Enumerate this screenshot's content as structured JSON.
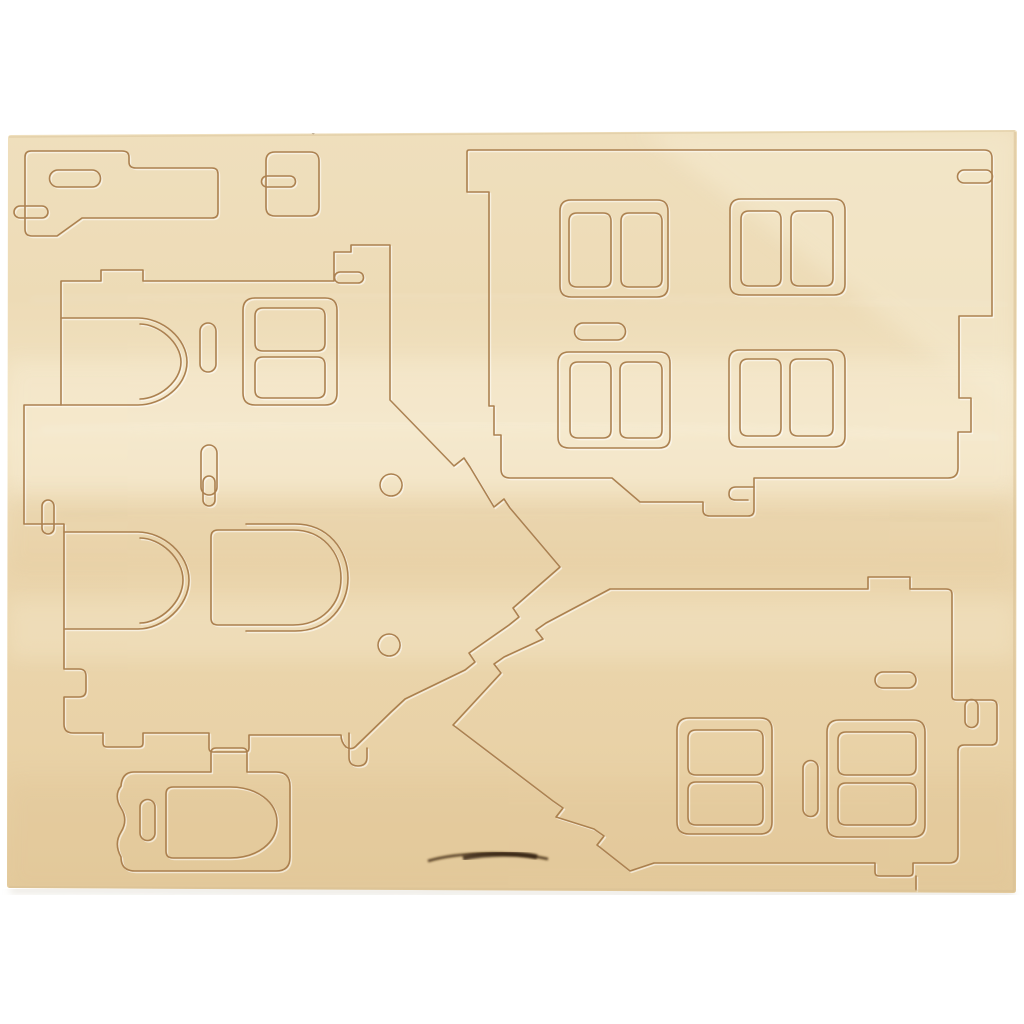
{
  "meta": {
    "description": "Photograph of a light birch plywood sheet with laser die-cut pieces for a 3D wooden house construction kit. No text is visible in the image.",
    "object": "wooden 3D-puzzle punch-out sheet",
    "piece_count_visible": 7
  },
  "colors": {
    "background": "#ffffff",
    "wood_top": "#efdfbd",
    "wood_upper": "#eddbb6",
    "wood_light": "#f3e5c6",
    "wood_mid": "#ebd6ae",
    "wood_lower": "#e9d2a7",
    "wood_bottom": "#e4cb9d",
    "band_light": "#f8eed6",
    "band_warm": "#dfc08c",
    "edge_line": "#d8c094",
    "cut_line": "#a87c4a",
    "emboss": "#ffffff",
    "burn": "#3c2710",
    "shadow": "#d8d2c4"
  },
  "pieces": [
    {
      "name": "chimney-support",
      "location": "top-left"
    },
    {
      "name": "small-connector-block",
      "location": "top-center-left"
    },
    {
      "name": "front-wall-four-windows",
      "location": "top-right"
    },
    {
      "name": "side-wall-arched-doorways",
      "location": "center-left"
    },
    {
      "name": "arched-door-panel",
      "location": "center"
    },
    {
      "name": "door-frame-panel",
      "location": "bottom-left"
    },
    {
      "name": "gable-wall-two-windows",
      "location": "bottom-right"
    }
  ],
  "sheet": {
    "outline": "M11,135 L1014,130 Q1017,130 1017,133 L1016,890 Q1016,893 1013,893 L10,888 Q7,888 7,885 L8,138 Q8,135 11,135 Z"
  },
  "grain": {
    "diag_highlight": "M1017,130 L640,130 L1017,420 Z",
    "mid_band": "M7,360 H1017 V500 H7 Z",
    "warm_band": "M7,492 H1017 V575 H7 Z",
    "low_light_band": "M7,600 H1017 V660 H7 Z",
    "bottom_band": "M7,780 H1017 V893 H7 Z",
    "streak1": "M40,430 C300,420 700,425 1000,438",
    "streak2": "M60,515 C350,505 650,512 990,520",
    "streak3": "M30,300 C300,292 600,296 1010,305",
    "burn_main": "M428,861 C458,852 512,851 548,859",
    "burn_core": "M463,858 C488,853 520,853 537,857",
    "speck": "M311,132 a2.2,2.2 0 1 0 4.4,0 a2.2,2.2 0 1 0 -4.4,0 Z"
  },
  "cuts": {
    "chimney_outline": "M31,151 H122 Q129,151 129,157 V162 Q129,168 136,168 H212 Q218,168 218,174 V212 Q218,218 212,218 H82 L57,236 H32 Q25,236 25,229 V157 Q25,151 31,151 Z",
    "chimney_oval": "M58,170 h34 a8.5,8.5 0 0 1 0,17 h-34 a8.5,8.5 0 0 1 0,-17 Z",
    "chimney_hook": "M20,206 h22 a6,6 0 0 1 0,12 h-22 a6,6 0 0 1 0,-12 Z",
    "connector_outline": "M275,152 h35 q9,0 9,9 v46 q0,9 -9,9 h-35 q-9,0 -9,-9 v-46 q0,-9 9,-9 Z",
    "connector_hook": "M267,176 h23 a5.5,5.5 0 0 1 0,11 h-23 a5.5,5.5 0 0 1 0,-11 Z",
    "wallA_outline": "M469,150 H984 Q992,150 992,158 V316 H959 V398 H971 V432 H958 V468 Q958,478 948,478 H754 V510 Q754,516 748,516 H710 Q703,516 703,510 V502 H640 L612,478 H510 Q501,478 501,469 V435 H494 V406 H489 V192 H467 V152 Q467,150 469,150 Z",
    "wallA_right_hook": "M964,170 h22 a6.5,6.5 0 0 1 0,13 h-22 a6.5,6.5 0 0 1 0,-13 Z",
    "wallA_tab_hook": "M754,487 H736 Q729,487 729,494 Q729,500 736,500 H748",
    "wallA_windows": "M571,200 h86 q11,0 11,11 v75 q0,11 -11,11 h-86 q-11,0 -11,-11 v-75 q0,-11 11,-11 Z M577,213 h26 q8,0 8,8 v58 q0,8 -8,8 h-26 q-8,0 -8,-8 v-58 q0,-8 8,-8 Z M629,213 h25 q8,0 8,8 v58 q0,8 -8,8 h-25 q-8,0 -8,-8 v-58 q0,-8 8,-8 Z M741,199 h93 q11,0 11,11 v74 q0,11 -11,11 h-93 q-11,0 -11,-11 v-74 q0,-11 11,-11 Z M749,211 h24 q8,0 8,8 v59 q0,8 -8,8 h-24 q-8,0 -8,-8 v-59 q0,-8 8,-8 Z M799,211 h26 q8,0 8,8 v59 q0,8 -8,8 h-26 q-8,0 -8,-8 v-59 q0,-8 8,-8 Z M569,352 h90 q11,0 11,11 v74 q0,11 -11,11 h-90 q-11,0 -11,-11 v-74 q0,-11 11,-11 Z M578,362 h25 q8,0 8,8 v60 q0,8 -8,8 h-25 q-8,0 -8,-8 v-60 q0,-8 8,-8 Z M628,362 h26 q8,0 8,8 v60 q0,8 -8,8 h-26 q-8,0 -8,-8 v-60 q0,-8 8,-8 Z M740,350 h94 q11,0 11,11 v75 q0,11 -11,11 h-94 q-11,0 -11,-11 v-75 q0,-11 11,-11 Z M748,359 h25 q8,0 8,8 v61 q0,8 -8,8 h-25 q-8,0 -8,-8 v-61 q0,-8 8,-8 Z M798,359 h27 q8,0 8,8 v61 q0,8 -8,8 h-27 q-8,0 -8,-8 v-61 q0,-8 8,-8 Z M583,323 h34 a8.5,8.5 0 0 1 0,17 h-34 a8.5,8.5 0 0 1 0,-17 Z",
    "wallL_outline": "M67,281 H101 V270 H143 V281 H334 V252 H351 V245 H390 V400 L454,466 l10,-8 l6,9 L494,507 l10,-8 l6,9 L560,567 L513,608 l6,9 l-10,8 L469,653 l6,9 l-10,8 L405,699 L391,712 L357,745 Q352,751 346,747 Q341,742 341,735 H249 V748 Q249,752 245,752 H213 Q209,752 209,748 V733 H143 V743 Q143,747 139,747 H107 Q103,747 103,743 V733 H73 Q64,733 64,724 V697 H79 Q86,697 86,690 V676 Q86,669 79,669 H64 V524 H24 V405 H61 V281 Z",
    "wallL_arches": "M61,318 H138 C162,318 187,338 187,362 C187,386 162,405 138,405 H61 M140,324 C158,324 181,342 181,362 C181,382 158,399 140,399 M64,532 H138 C163,532 189,554 189,580 C189,606 163,629 138,629 H64 M140,538 C160,538 183,558 183,580 C183,602 160,623 140,623",
    "wallL_features": "M255,298 h70 q12,0 12,12 v83 q0,12 -12,12 h-70 q-12,0 -12,-12 v-83 q0,-12 12,-12 Z M263,308 h54 q8,0 8,8 v27 q0,8 -8,8 h-54 q-8,0 -8,-8 v-27 q0,-8 8,-8 Z M263,357 h54 q8,0 8,8 v25 q0,8 -8,8 h-54 q-8,0 -8,-8 v-25 q0,-8 8,-8 Z M216,331 v33 a8,8 0 0 1 -16,0 v-33 a8,8 0 0 1 16,0 Z M217,453 v34 a8,8 0 0 1 -16,0 v-34 a8,8 0 0 1 16,0 Z M391,474 a11,11 0 1 0 0.1,0 Z M389,634 a11,11 0 1 0 0.1,0 Z M340,272 h18 a5.5,5.5 0 0 1 0,11 h-18 a5.5,5.5 0 0 1 0,-11 Z M54,506 v22 a6,6 0 0 1 -12,0 v-22 a6,6 0 0 1 12,0 Z M349,733 V757 Q349,766 358,766 Q367,766 367,757 V748",
    "door_arched": "M218,530 H293 C322,530 341,552 341,578 C341,604 322,625 293,625 H218 Q211,625 211,618 V537 Q211,530 218,530 Z",
    "door_arched_kerf": "M246,524 H295 C328,524 348,550 348,578 C348,606 328,631 295,631 H246",
    "door_arched_hook": "M215,482 v18 a6,6 0 0 1 -12,0 v-18 a6,6 0 0 1 12,0 Z",
    "doorframe_outline": "M134,772 H211 V753 Q211,748 216,748 H242 Q247,748 247,753 V772 H276 Q290,772 290,786 V857 Q290,871 276,871 H135 Q121,871 121,857 C116,848 116,840 121,832 C126,824 126,816 121,808 C116,800 116,792 121,786 Q122,772 134,772 Z",
    "doorframe_door": "M173,787 H230 C257,787 277,802 277,822 C277,843 257,858 230,858 H173 Q166,858 166,851 V794 Q166,787 173,787 Z",
    "doorframe_slot": "M155,807 v26 a7.5,7.5 0 0 1 -15,0 v-26 a7.5,7.5 0 0 1 15,0 Z",
    "wallB_outline": "M453,725 L501,673 l-7,-9 l10,-7 L543,639 l-7,-9 l10,-7 L610,589 H868 V577 H910 V589 H946 Q952,589 952,594 V696 Q952,700 956,700 H991 Q997,700 997,706 V739 Q997,745 991,745 H964 Q958,745 958,751 V854 Q958,863 949,863 H913 V872 Q913,876 909,876 H879 Q875,876 875,872 V863 H654 L630,871 L597,845 l7,-9 l-10,-7 L556,817 l7,-9 l-10,-7 Z",
    "wallB_right_hook": "M978,706 v15 a6.5,6.5 0 0 1 -13,0 v-15 a6.5,6.5 0 0 1 13,0 Z",
    "wallB_bottom_line": "M916,876 V890",
    "wallB_windows": "M689,718 h71 q12,0 12,12 v92 q0,12 -12,12 h-71 q-12,0 -12,-12 v-92 q0,-12 12,-12 Z M696,730 h59 q8,0 8,8 v29 q0,8 -8,8 h-59 q-8,0 -8,-8 v-29 q0,-8 8,-8 Z M696,782 h59 q8,0 8,8 v27 q0,8 -8,8 h-59 q-8,0 -8,-8 v-27 q0,-8 8,-8 Z M839,720 h74 q12,0 12,12 v93 q0,12 -12,12 h-74 q-12,0 -12,-12 v-93 q0,-12 12,-12 Z M846,732 h62 q8,0 8,8 v27 q0,8 -8,8 h-62 q-8,0 -8,-8 v-27 q0,-8 8,-8 Z M846,783 h62 q8,0 8,8 v26 q0,8 -8,8 h-62 q-8,0 -8,-8 v-26 q0,-8 8,-8 Z M818,768 v41 a7.5,7.5 0 0 1 -15,0 v-41 a7.5,7.5 0 0 1 15,0 Z M883,672 h25 a8,8 0 0 1 0,16 h-25 a8,8 0 0 1 0,-16 Z"
  }
}
